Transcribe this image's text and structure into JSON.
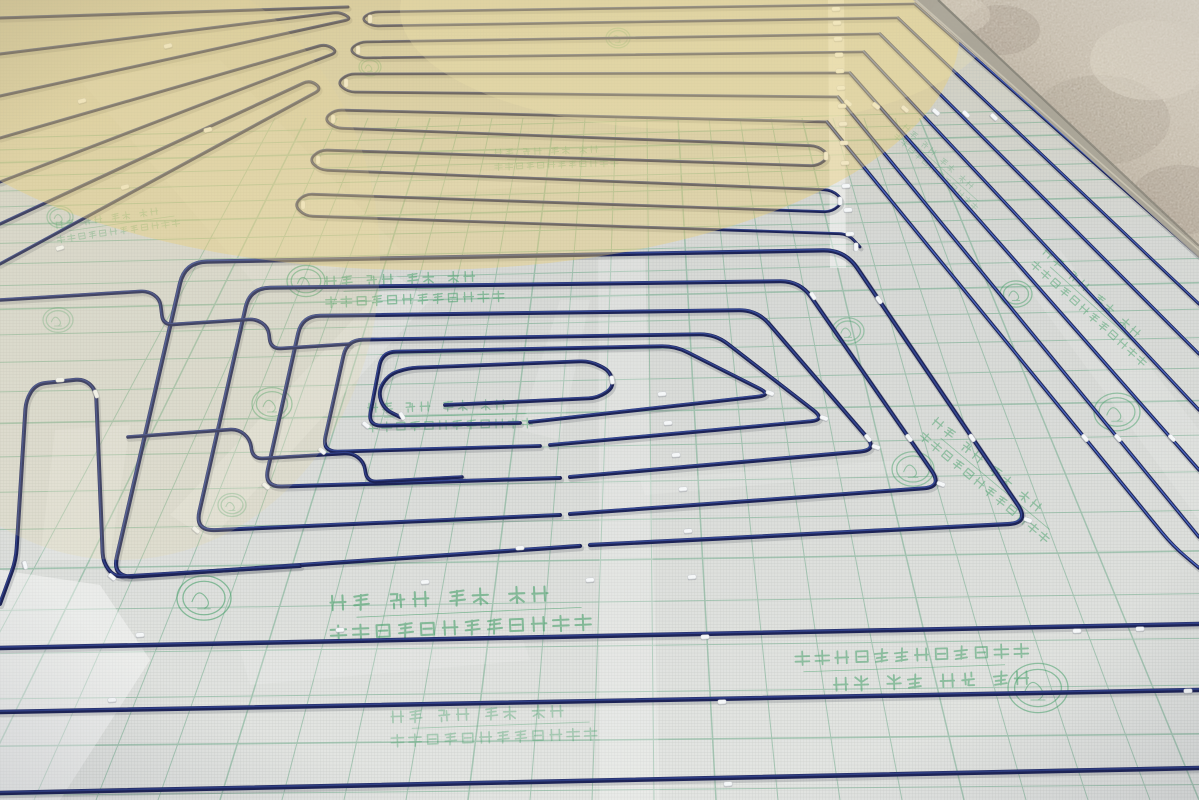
{
  "image": {
    "width": 1199,
    "height": 800,
    "kind": "photograph",
    "description": "Construction photo: blue PEX underfloor-heating pipe laid in serpentine and spiral loops, fixed with white clips onto silver insulation foil printed with a green grid, green Chinese slogans and round brand stamps; bare plaster wall in the top-right corner; warm sunlight across the top."
  },
  "palette": {
    "foil_top": "#cfcdbd",
    "foil_mid": "#d7d9d6",
    "foil_bottom": "#e4e6e3",
    "mesh_line": "#b4b7b4",
    "grid_green": "#5fa37f",
    "print_green": "#3c9c62",
    "pipe_dark": "#1d2356",
    "pipe_highlight": "#5d80e8",
    "pipe_highlight_dim": "#4a67c8",
    "clip_white": "#f5f7f8",
    "wall_dark": "#9a8c7c",
    "wall_light": "#d8d0bf",
    "sun_warm": "#eccf72"
  },
  "foil_print": {
    "line1": "绿色 环保 高效 节能",
    "line2": "地暖专用纯铝箔导热反射膜"
  },
  "grid": {
    "rows": [
      122,
      134,
      147,
      161,
      176,
      192,
      210,
      229,
      250,
      272,
      296,
      322,
      350,
      380,
      412,
      446,
      482,
      520,
      560,
      602,
      646,
      692,
      740,
      790
    ],
    "cols_bottom": [
      -90,
      -28,
      34,
      96,
      158,
      220,
      282,
      344,
      406,
      468,
      530,
      592,
      654,
      716,
      778,
      840,
      902,
      964,
      1026,
      1088,
      1150,
      1199
    ],
    "col_center": 640,
    "col_top_factor": 0.5,
    "col_top_y": 118,
    "opacity": 0.45
  },
  "glows": [
    {
      "cx": 420,
      "cy": 30,
      "rx": 540,
      "ry": 240,
      "color": "#eccf72",
      "op": 0.4
    },
    {
      "cx": 120,
      "cy": 260,
      "rx": 260,
      "ry": 300,
      "color": "#e8d79a",
      "op": 0.18
    },
    {
      "cx": 700,
      "cy": 10,
      "rx": 300,
      "ry": 120,
      "color": "#f3e7ae",
      "op": 0.25
    }
  ],
  "streaks": [
    {
      "pts": [
        [
          598,
          258
        ],
        [
          645,
          258
        ],
        [
          660,
          800
        ],
        [
          600,
          800
        ]
      ],
      "op": 0.2
    },
    {
      "pts": [
        [
          828,
          0
        ],
        [
          844,
          0
        ],
        [
          846,
          268
        ],
        [
          830,
          268
        ]
      ],
      "op": 0.45
    },
    {
      "pts": [
        [
          170,
          515
        ],
        [
          210,
          540
        ],
        [
          430,
          300
        ],
        [
          395,
          275
        ]
      ],
      "op": 0.18
    },
    {
      "pts": [
        [
          0,
          570
        ],
        [
          100,
          585
        ],
        [
          150,
          660
        ],
        [
          60,
          800
        ],
        [
          0,
          800
        ]
      ],
      "op": 0.4
    },
    {
      "pts": [
        [
          1000,
          250
        ],
        [
          1060,
          250
        ],
        [
          1199,
          430
        ],
        [
          1199,
          520
        ]
      ],
      "op": 0.12
    },
    {
      "pts": [
        [
          520,
          430
        ],
        [
          560,
          300
        ],
        [
          590,
          300
        ],
        [
          560,
          440
        ]
      ],
      "op": 0.14
    },
    {
      "pts": [
        [
          640,
          480
        ],
        [
          900,
          460
        ],
        [
          905,
          472
        ],
        [
          645,
          495
        ]
      ],
      "op": 0.13
    },
    {
      "pts": [
        [
          350,
          180
        ],
        [
          820,
          150
        ],
        [
          820,
          165
        ],
        [
          350,
          200
        ]
      ],
      "op": 0.12
    },
    {
      "pts": [
        [
          55,
          430
        ],
        [
          130,
          425
        ],
        [
          110,
          560
        ],
        [
          40,
          560
        ]
      ],
      "op": 0.16
    },
    {
      "pts": [
        [
          240,
          650
        ],
        [
          520,
          632
        ],
        [
          530,
          660
        ],
        [
          250,
          685
        ]
      ],
      "op": 0.13
    },
    {
      "pts": [
        [
          80,
          80
        ],
        [
          220,
          60
        ],
        [
          400,
          250
        ],
        [
          260,
          290
        ]
      ],
      "op": 0.1
    }
  ],
  "pipes": [
    {
      "pts": [
        [
          0,
          18
        ],
        [
          348,
          7
        ]
      ],
      "w": 3,
      "hl": 0.2,
      "r": 10
    },
    {
      "pts": [
        [
          0,
          54
        ],
        [
          340,
          12
        ],
        [
          352,
          19
        ],
        [
          0,
          96
        ]
      ],
      "w": 3,
      "hl": 0.2,
      "r": 10
    },
    {
      "pts": [
        [
          0,
          138
        ],
        [
          326,
          44
        ],
        [
          338,
          52
        ],
        [
          0,
          182
        ]
      ],
      "w": 3,
      "hl": 0.2,
      "r": 10
    },
    {
      "pts": [
        [
          0,
          224
        ],
        [
          310,
          80
        ],
        [
          322,
          89
        ],
        [
          0,
          264
        ]
      ],
      "w": 3.2,
      "hl": 0.2,
      "r": 10
    },
    {
      "pts": [
        [
          915,
          4
        ],
        [
          372,
          12
        ],
        [
          361,
          19
        ],
        [
          372,
          26
        ],
        [
          898,
          18
        ]
      ],
      "w": 2.6,
      "hl": 0.25,
      "r": 8
    },
    {
      "pts": [
        [
          880,
          34
        ],
        [
          360,
          42
        ],
        [
          349,
          50
        ],
        [
          360,
          58
        ],
        [
          864,
          52
        ]
      ],
      "w": 2.6,
      "hl": 0.25,
      "r": 8
    },
    {
      "pts": [
        [
          850,
          73
        ],
        [
          348,
          74
        ],
        [
          337,
          83
        ],
        [
          348,
          92
        ],
        [
          838,
          97
        ]
      ],
      "w": 2.7,
      "hl": 0.25,
      "r": 8
    },
    {
      "pts": [
        [
          827,
          122
        ],
        [
          335,
          110
        ],
        [
          324,
          119
        ],
        [
          335,
          128
        ],
        [
          818,
          146
        ],
        [
          830,
          156
        ],
        [
          818,
          166
        ],
        [
          320,
          150
        ],
        [
          309,
          160
        ],
        [
          320,
          170
        ],
        [
          832,
          190
        ],
        [
          844,
          201
        ],
        [
          832,
          212
        ],
        [
          305,
          194
        ],
        [
          294,
          205
        ],
        [
          305,
          216
        ],
        [
          848,
          234
        ],
        [
          860,
          247
        ]
      ],
      "w": 2.8,
      "hl": 0.25,
      "r": 9
    },
    {
      "pts": [
        [
          915,
          4
        ],
        [
          1199,
          256
        ]
      ],
      "w": 3,
      "hl": 0.7,
      "r": 10
    },
    {
      "pts": [
        [
          898,
          18
        ],
        [
          1199,
          304
        ]
      ],
      "w": 3,
      "hl": 0.7,
      "r": 10
    },
    {
      "pts": [
        [
          880,
          34
        ],
        [
          1199,
          354
        ]
      ],
      "w": 3.2,
      "hl": 0.8,
      "r": 10
    },
    {
      "pts": [
        [
          864,
          52
        ],
        [
          1199,
          410
        ]
      ],
      "w": 3.2,
      "hl": 0.8,
      "r": 10
    },
    {
      "pts": [
        [
          850,
          73
        ],
        [
          1199,
          470
        ]
      ],
      "w": 3.4,
      "hl": 0.8,
      "r": 10
    },
    {
      "pts": [
        [
          838,
          97
        ],
        [
          1199,
          537
        ]
      ],
      "w": 3.4,
      "hl": 0.8,
      "r": 10
    },
    {
      "pts": [
        [
          827,
          122
        ],
        [
          1173,
          546
        ],
        [
          1199,
          568
        ]
      ],
      "w": 3.4,
      "hl": 0.8,
      "r": 20
    },
    {
      "pts": [
        [
          580,
          546
        ],
        [
          112,
          578
        ],
        [
          185,
          262
        ],
        [
          845,
          250
        ],
        [
          1030,
          523
        ],
        [
          590,
          545
        ]
      ],
      "w": 4.2,
      "hl": 0.45,
      "r": 22
    },
    {
      "pts": [
        [
          560,
          515
        ],
        [
          195,
          531
        ],
        [
          250,
          288
        ],
        [
          800,
          281
        ],
        [
          943,
          487
        ],
        [
          570,
          514
        ]
      ],
      "w": 4,
      "hl": 0.45,
      "r": 20
    },
    {
      "pts": [
        [
          560,
          478
        ],
        [
          264,
          487
        ],
        [
          302,
          316
        ],
        [
          757,
          310
        ],
        [
          878,
          450
        ],
        [
          570,
          477
        ]
      ],
      "w": 4,
      "hl": 0.45,
      "r": 18
    },
    {
      "pts": [
        [
          540,
          446
        ],
        [
          322,
          452
        ],
        [
          347,
          340
        ],
        [
          715,
          334
        ],
        [
          826,
          420
        ],
        [
          550,
          445
        ]
      ],
      "w": 3.8,
      "hl": 0.45,
      "r": 16
    },
    {
      "pts": [
        [
          520,
          423
        ],
        [
          368,
          426
        ],
        [
          382,
          352
        ],
        [
          675,
          346
        ],
        [
          772,
          395
        ],
        [
          530,
          422
        ]
      ],
      "w": 3.8,
      "hl": 0.4,
      "r": 14
    },
    {
      "pts": [
        [
          400,
          417
        ],
        [
          384,
          409
        ],
        [
          378,
          392
        ],
        [
          388,
          375
        ],
        [
          408,
          368
        ],
        [
          590,
          361
        ],
        [
          610,
          371
        ],
        [
          614,
          387
        ],
        [
          598,
          398
        ],
        [
          445,
          405
        ]
      ],
      "w": 3.8,
      "hl": 0.3,
      "r": 10
    },
    {
      "pts": [
        [
          0,
          604
        ],
        [
          16,
          560
        ],
        [
          26,
          400
        ],
        [
          36,
          384
        ],
        [
          84,
          379
        ],
        [
          96,
          390
        ],
        [
          103,
          562
        ],
        [
          114,
          577
        ],
        [
          300,
          566
        ]
      ],
      "w": 4,
      "hl": 0.3,
      "r": 12
    },
    {
      "pts": [
        [
          0,
          300
        ],
        [
          148,
          291
        ],
        [
          160,
          299
        ],
        [
          163,
          325
        ],
        [
          256,
          319
        ],
        [
          268,
          327
        ],
        [
          271,
          349
        ],
        [
          350,
          344
        ]
      ],
      "w": 3.6,
      "hl": 0.3,
      "r": 10
    },
    {
      "pts": [
        [
          128,
          437
        ],
        [
          238,
          429
        ],
        [
          250,
          439
        ],
        [
          253,
          459
        ],
        [
          352,
          453
        ],
        [
          364,
          462
        ],
        [
          367,
          482
        ],
        [
          462,
          477
        ]
      ],
      "w": 3.6,
      "hl": 0.3,
      "r": 10
    },
    {
      "pts": [
        [
          0,
          648
        ],
        [
          1199,
          624
        ]
      ],
      "w": 4.5,
      "hl": 0.3,
      "r": 10
    },
    {
      "pts": [
        [
          0,
          712
        ],
        [
          1199,
          690
        ]
      ],
      "w": 4.5,
      "hl": 0.3,
      "r": 10
    },
    {
      "pts": [
        [
          0,
          793
        ],
        [
          1199,
          768
        ]
      ],
      "w": 4.6,
      "hl": 0.25,
      "r": 10
    }
  ],
  "clips": [
    [
      836,
      9,
      -2
    ],
    [
      837,
      23,
      -2
    ],
    [
      838,
      39,
      -2
    ],
    [
      839,
      55,
      -2
    ],
    [
      840,
      71,
      -2
    ],
    [
      841,
      88,
      -2
    ],
    [
      842,
      106,
      -2
    ],
    [
      843,
      124,
      -2
    ],
    [
      844,
      143,
      -2
    ],
    [
      845,
      163,
      -2
    ],
    [
      846,
      186,
      -2
    ],
    [
      848,
      210,
      -2
    ],
    [
      850,
      234,
      -2
    ],
    [
      848,
      103,
      40
    ],
    [
      876,
      106,
      40
    ],
    [
      905,
      109,
      42
    ],
    [
      936,
      112,
      42
    ],
    [
      966,
      114,
      44
    ],
    [
      994,
      117,
      44
    ],
    [
      370,
      19,
      90
    ],
    [
      358,
      50,
      90
    ],
    [
      346,
      83,
      90
    ],
    [
      333,
      119,
      90
    ],
    [
      318,
      160,
      90
    ],
    [
      303,
      205,
      90
    ],
    [
      168,
      46,
      -13
    ],
    [
      82,
      101,
      -15
    ],
    [
      208,
      130,
      -14
    ],
    [
      125,
      187,
      -16
    ],
    [
      60,
      248,
      -16
    ],
    [
      826,
      156,
      90
    ],
    [
      840,
      201,
      90
    ],
    [
      856,
      247,
      90
    ],
    [
      60,
      380,
      -3
    ],
    [
      96,
      394,
      70
    ],
    [
      25,
      565,
      75
    ],
    [
      112,
      577,
      40
    ],
    [
      196,
      530,
      40
    ],
    [
      266,
      486,
      40
    ],
    [
      322,
      451,
      40
    ],
    [
      366,
      425,
      40
    ],
    [
      662,
      394,
      -4
    ],
    [
      668,
      423,
      -4
    ],
    [
      676,
      455,
      -4
    ],
    [
      683,
      489,
      -4
    ],
    [
      688,
      531,
      -4
    ],
    [
      692,
      577,
      -4
    ],
    [
      868,
      438,
      50
    ],
    [
      909,
      438,
      52
    ],
    [
      972,
      438,
      55
    ],
    [
      1085,
      438,
      50
    ],
    [
      1118,
      438,
      48
    ],
    [
      1172,
      438,
      45
    ],
    [
      1028,
      520,
      20
    ],
    [
      941,
      484,
      20
    ],
    [
      876,
      447,
      20
    ],
    [
      824,
      418,
      20
    ],
    [
      770,
      393,
      20
    ],
    [
      140,
      635,
      -3
    ],
    [
      112,
      700,
      -3
    ],
    [
      340,
      630,
      -3
    ],
    [
      425,
      582,
      -4
    ],
    [
      705,
      637,
      -3
    ],
    [
      722,
      702,
      -3
    ],
    [
      728,
      784,
      -3
    ],
    [
      1077,
      631,
      -2
    ],
    [
      1140,
      629,
      -2
    ],
    [
      1188,
      691,
      -2
    ],
    [
      590,
      580,
      -4
    ],
    [
      520,
      548,
      -4
    ],
    [
      402,
      416,
      60
    ],
    [
      612,
      380,
      80
    ],
    [
      879,
      300,
      55
    ],
    [
      813,
      296,
      55
    ]
  ],
  "prints": [
    {
      "x": 420,
      "y": 272,
      "s": 13,
      "rot": -2,
      "op": 0.5
    },
    {
      "x": 455,
      "y": 400,
      "s": 12,
      "rot": -1.5,
      "op": 0.45
    },
    {
      "x": 468,
      "y": 588,
      "s": 19,
      "rot": -2.5,
      "op": 0.55
    },
    {
      "x": 905,
      "y": 690,
      "s": 17,
      "rot": 178,
      "op": 0.5
    },
    {
      "x": 560,
      "y": 146,
      "s": 9,
      "rot": -2,
      "op": 0.3
    },
    {
      "x": 1108,
      "y": 300,
      "s": 11,
      "rot": 42,
      "op": 0.45
    },
    {
      "x": 1005,
      "y": 472,
      "s": 12,
      "rot": 40,
      "op": 0.45
    },
    {
      "x": 120,
      "y": 212,
      "s": 9,
      "rot": -8,
      "op": 0.35
    },
    {
      "x": 500,
      "y": 706,
      "s": 15,
      "rot": -2,
      "op": 0.35
    },
    {
      "x": 950,
      "y": 162,
      "s": 8,
      "rot": 42,
      "op": 0.28
    }
  ],
  "logos": [
    [
      306,
      281,
      19,
      0.5
    ],
    [
      272,
      404,
      20,
      0.45
    ],
    [
      204,
      598,
      27,
      0.55
    ],
    [
      1038,
      688,
      30,
      0.5
    ],
    [
      1016,
      294,
      16,
      0.45
    ],
    [
      913,
      469,
      21,
      0.45
    ],
    [
      60,
      217,
      13,
      0.35
    ],
    [
      848,
      331,
      16,
      0.4
    ],
    [
      1117,
      412,
      23,
      0.45
    ],
    [
      58,
      320,
      15,
      0.3
    ],
    [
      370,
      67,
      11,
      0.3
    ],
    [
      618,
      38,
      12,
      0.3
    ],
    [
      232,
      505,
      14,
      0.3
    ]
  ],
  "wall": {
    "poly": [
      [
        913,
        0
      ],
      [
        1199,
        0
      ],
      [
        1199,
        256
      ]
    ],
    "base_band": [
      [
        915,
        0
      ],
      [
        940,
        0
      ],
      [
        1199,
        248
      ],
      [
        1199,
        258
      ]
    ],
    "blotches": [
      [
        1000,
        30,
        40,
        25,
        "#8f8273",
        0.35
      ],
      [
        1100,
        120,
        70,
        45,
        "#968a7c",
        0.3
      ],
      [
        1180,
        200,
        50,
        35,
        "#8a7f72",
        0.3
      ],
      [
        960,
        15,
        30,
        18,
        "#c9bfae",
        0.5
      ],
      [
        1150,
        60,
        60,
        40,
        "#d6cdbc",
        0.5
      ]
    ]
  }
}
